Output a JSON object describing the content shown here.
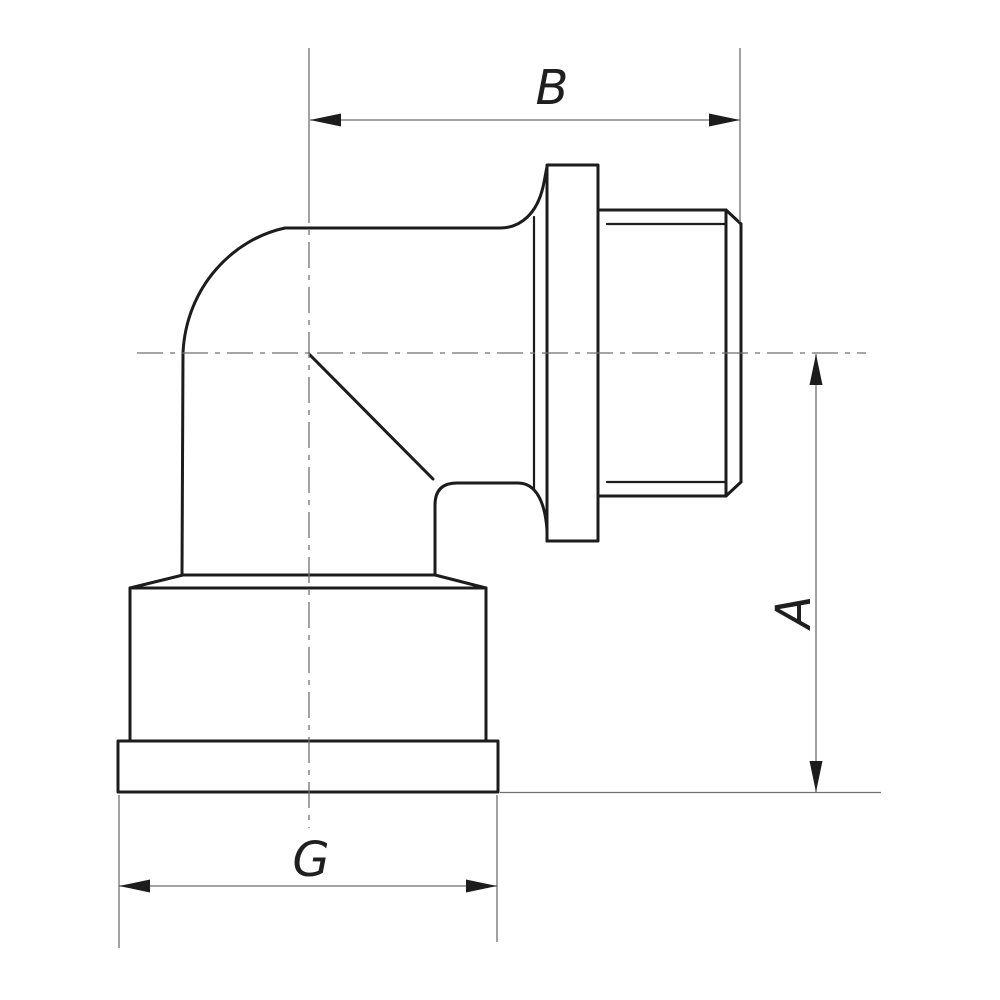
{
  "drawing": {
    "kind": "elbow-fitting-technical-drawing",
    "labels": {
      "width_top": "B",
      "height_right": "A",
      "width_bottom": "G"
    },
    "colors": {
      "background": "#ffffff",
      "outline": "#1c1c1c",
      "thin_line": "#6f6f6f",
      "arrow": "#1c1c1c",
      "label": "#1f1f1f"
    }
  }
}
